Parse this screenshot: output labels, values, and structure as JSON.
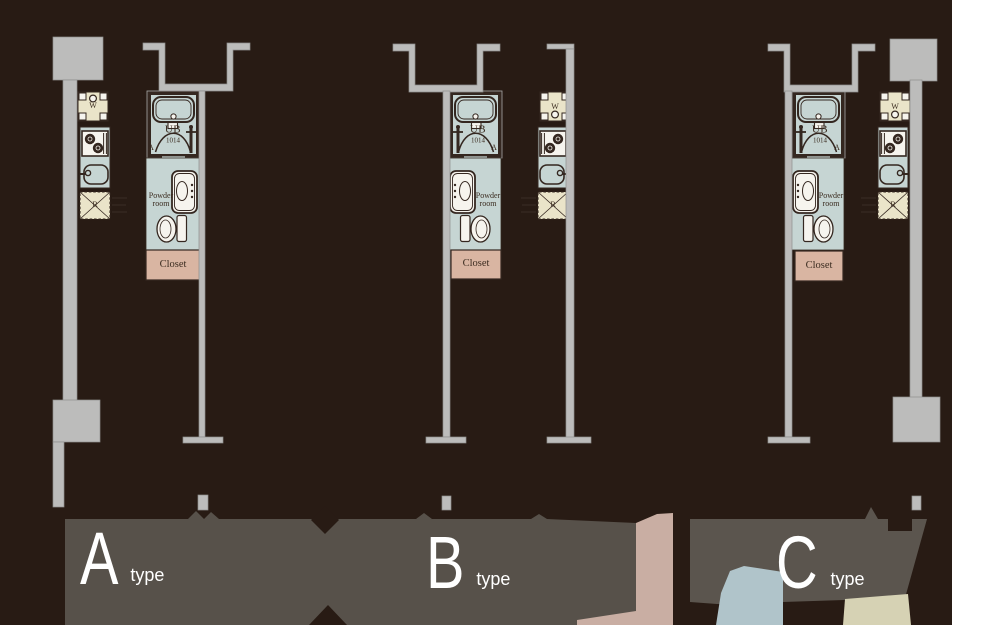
{
  "palette": {
    "background": "#281b14",
    "wall": "#bcbcbb",
    "wall_stroke": "#8e8e8d",
    "unit_blue": "#c6d5d3",
    "unit_beige": "#eae4c9",
    "closet_pink": "#d9b5a2",
    "line_dark": "#342720",
    "fixture_white": "#f6f4ee",
    "band_gray": "#57514a",
    "band_gray2": "#5b554e",
    "patch_pink": "#c9aea3",
    "patch_blue": "#b0c4ca",
    "patch_beige": "#d6d2b4",
    "white_strip": "#ffffff",
    "label_dark": "#3b2c20",
    "type_text": "#ffffff"
  },
  "plans": [
    {
      "type_letter": "A",
      "type_word": "type",
      "bath_label": "UB",
      "bath_size": "1014",
      "bath_door_letter": "A",
      "powder_room_line1": "Powder",
      "powder_room_line2": "room",
      "closet_label": "Closet",
      "washer_label": "W",
      "refrigerator_label": "R"
    },
    {
      "type_letter": "B",
      "type_word": "type",
      "bath_label": "UB",
      "bath_size": "1014",
      "bath_door_letter": "A",
      "powder_room_line1": "Powder",
      "powder_room_line2": "room",
      "closet_label": "Closet",
      "washer_label": "W",
      "refrigerator_label": "R"
    },
    {
      "type_letter": "C",
      "type_word": "type",
      "bath_label": "UB",
      "bath_size": "1014",
      "bath_door_letter": "A",
      "powder_room_line1": "Powder",
      "powder_room_line2": "room",
      "closet_label": "Closet",
      "washer_label": "W",
      "refrigerator_label": "R"
    }
  ]
}
